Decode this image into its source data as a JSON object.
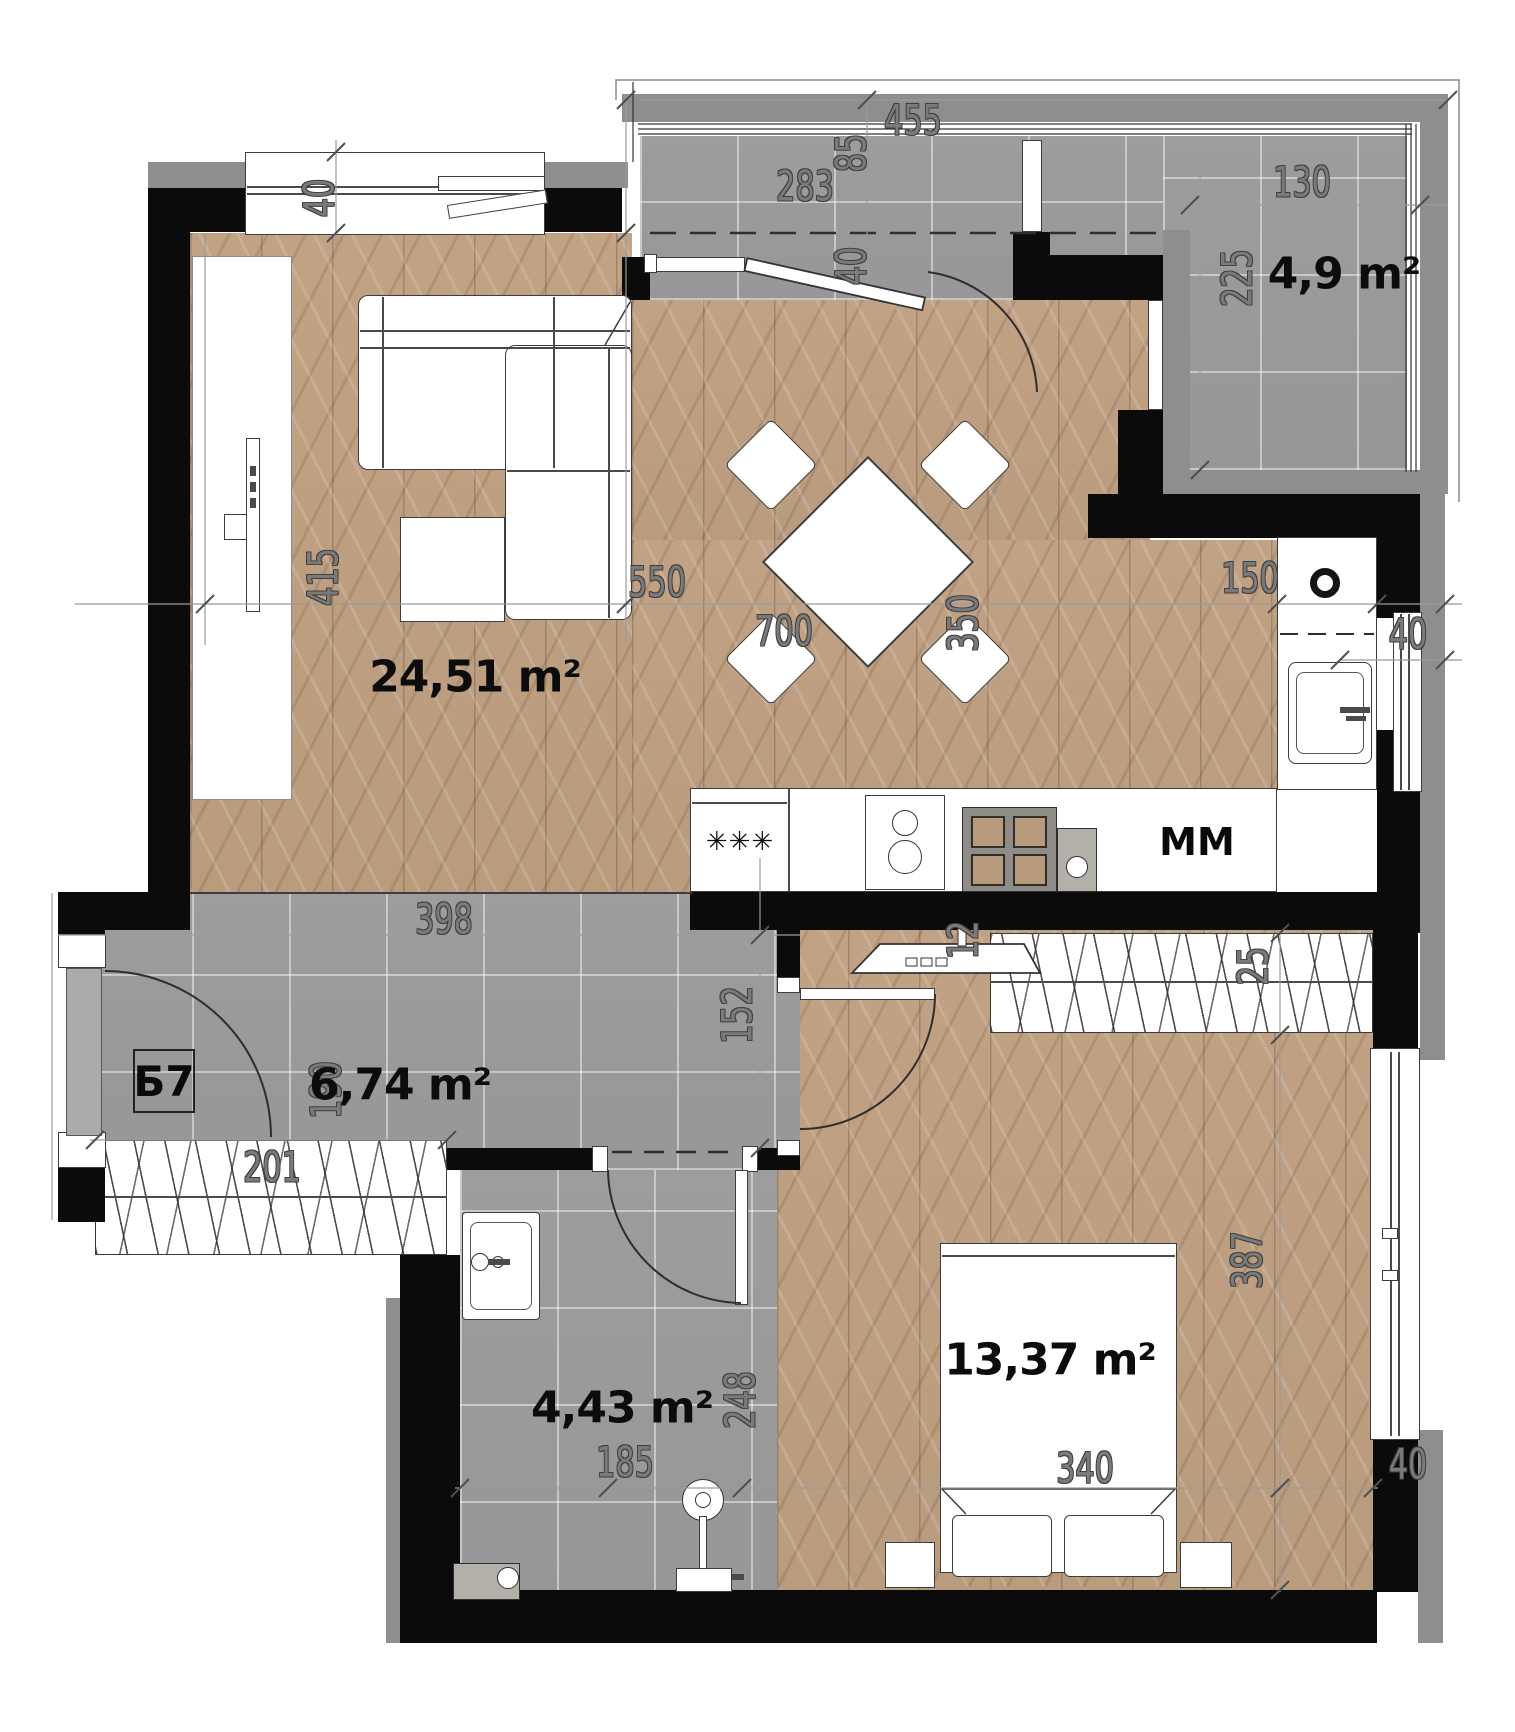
{
  "plan": {
    "unit_label": "Б7",
    "areas": {
      "living_kitchen": "24,51 m²",
      "balcony": "4,9 m²",
      "hallway": "6,74 m²",
      "bathroom": "4,43 m²",
      "bedroom": "13,37 m²"
    },
    "appliances": {
      "washing_machine": "MM",
      "freezer_stars": "✳✳✳"
    },
    "dims": {
      "balcony_total_width": "455",
      "balcony_left_width": "283",
      "balcony_overhang": "85",
      "balcony_right_width": "130",
      "balcony_right_depth": "225",
      "balcony_wall_thickness": "40",
      "living_window_wall": "40",
      "living_left_depth": "415",
      "sofa_length": "550",
      "living_width": "700",
      "dining_table": "350",
      "kitchen_depth": "150",
      "kitchen_wall": "40",
      "hallway_width": "398",
      "hallway_right_depth": "152",
      "hallway_left_depth": "190",
      "hallway_bottom_width": "201",
      "bedroom_radiator": "12",
      "bedroom_wardrobe_depth": "25",
      "bathroom_depth": "248",
      "bathroom_width": "185",
      "bed_width": "340",
      "bedroom_depth": "387",
      "bedroom_wall": "40"
    }
  }
}
